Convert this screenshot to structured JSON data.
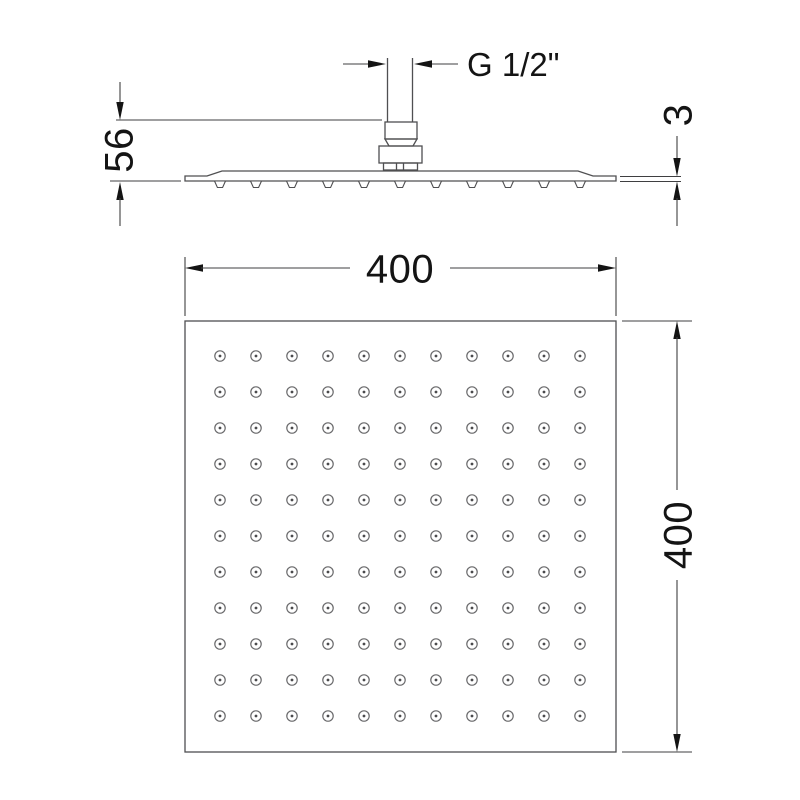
{
  "drawing": {
    "title": "square-shower-head-dimension-drawing",
    "labels": {
      "thread_size": "G 1/2\"",
      "head_height": "56",
      "plate_thickness": "3",
      "plate_width": "400",
      "plate_depth": "400"
    },
    "side_view": {
      "nozzle_count": 11,
      "nozzle_pitch": 36,
      "nozzle_start_x": 220,
      "nozzle_y": 181
    },
    "bottom_view": {
      "hole_rows": 11,
      "hole_cols": 11,
      "hole_pitch": 36,
      "hole_start_x": 220,
      "hole_start_y": 356,
      "hole_outer_r": 5.2,
      "hole_inner_r": 1.4
    },
    "colors": {
      "background": "#ffffff",
      "line": "#4f4f51",
      "dimension_line": "#3f3f41",
      "text": "#141414"
    }
  }
}
